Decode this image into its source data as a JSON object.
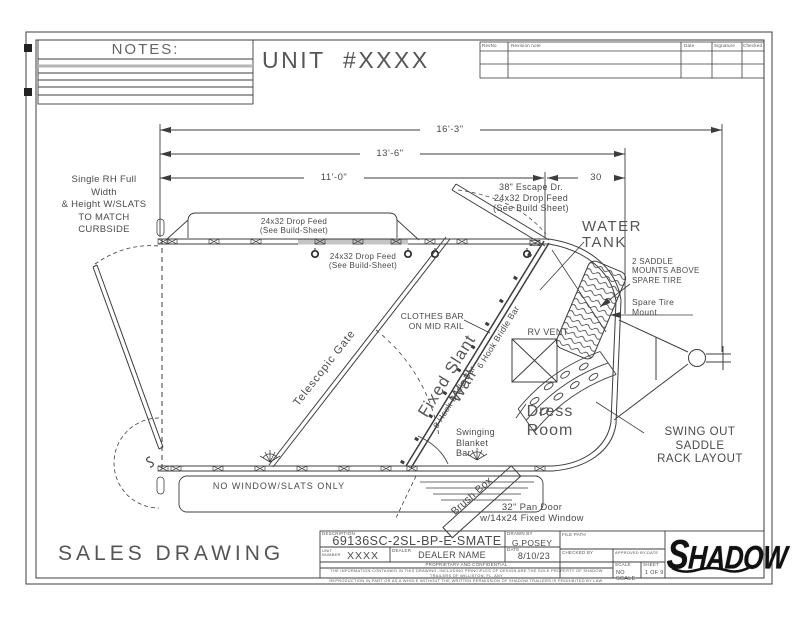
{
  "sheet": {
    "notes_title": "NOTES:",
    "unit_title": "UNIT  #XXXX",
    "sales_drawing": "SALES DRAWING"
  },
  "revision_table": {
    "headers": {
      "rev_no": "RevNo",
      "note": "Revision note",
      "date": "Date",
      "signature": "Signature",
      "checked": "Checked"
    }
  },
  "dimensions": {
    "overall_length": "16'-3\"",
    "body_length": "13'-6\"",
    "stall_length": "11'-0\"",
    "dress_length": "30"
  },
  "annotations": {
    "curbside_note": "Single RH Full\nWidth\n& Height W/SLATS\nTO MATCH\nCURBSIDE",
    "drop_feed_1": "24x32 Drop Feed\n(See Build-Sheet)",
    "drop_feed_2": "24x32 Drop Feed\n(See Build-Sheet)",
    "escape_door": "38\" Escape Dr.\n24x32 Drop Feed\n(See Build Sheet)",
    "water_tank": "WATER\nTANK",
    "saddle_mounts": "2 SADDLE\nMOUNTS ABOVE\nSPARE TIRE",
    "spare_tire": "Spare Tire\nMount",
    "clothes_bar": "CLOTHES BAR\nON MID RAIL",
    "rv_vent": "RV VENT",
    "telescopic_gate": "Telescopic Gate",
    "fixed_slant_wall": "Fixed Slant Wall",
    "bridle_bar_lower": "6 Hook Bridle Bar",
    "bridle_bar_upper": "6 Hook Bridle Bar",
    "dress_room": "Dress\nRoom",
    "saddle_rack": "SWING OUT SADDLE\nRACK LAYOUT",
    "blanket_bar": "Swinging\nBlanket\nBar",
    "brush_box": "Brush Box",
    "pan_door": "32\" Pan Door\nw/14x24 Fixed Window",
    "no_window": "NO WINDOW/SLATS ONLY"
  },
  "title_block": {
    "description_label": "DESCRIPTION",
    "description": "69136SC-2SL-BP-E-SMATE",
    "unit_number_label": "UNIT\nNUMBER",
    "unit_number": "XXXX",
    "dealer_label": "DEALER",
    "dealer": "DEALER NAME",
    "drawn_by_label": "DRAWN BY",
    "drawn_by": "G.POSEY",
    "date_label": "DATE",
    "date": "8/10/23",
    "file_path_label": "FILE PATH",
    "checked_by_label": "CHECKED BY",
    "approved_label": "APPROVED BY-DATE",
    "scale_label": "SCALE",
    "scale": "NO SCALE",
    "sheet_label": "SHEET",
    "sheet": "1 OF 9",
    "proprietary": "PROPRIETARY AND CONFIDENTIAL",
    "legal": "THE INFORMATION CONTAINED IN THIS DRAWING, INCLUDING PRINCIPLES OF DESIGN ARE THE SOLE PROPERTY OF SHADOW TRAILERS OF WILLISTON, FL. ANY\nREPRODUCTION IN PART OR AS A WHOLE WITHOUT THE WRITTEN PERMISSION OF SHADOW TRAILERS IS PROHIBITED BY LAW.",
    "logo": "SHADOW"
  },
  "colors": {
    "line": "#3d3d3d",
    "text": "#4a4a4a",
    "shade": "#c4c4c4"
  }
}
